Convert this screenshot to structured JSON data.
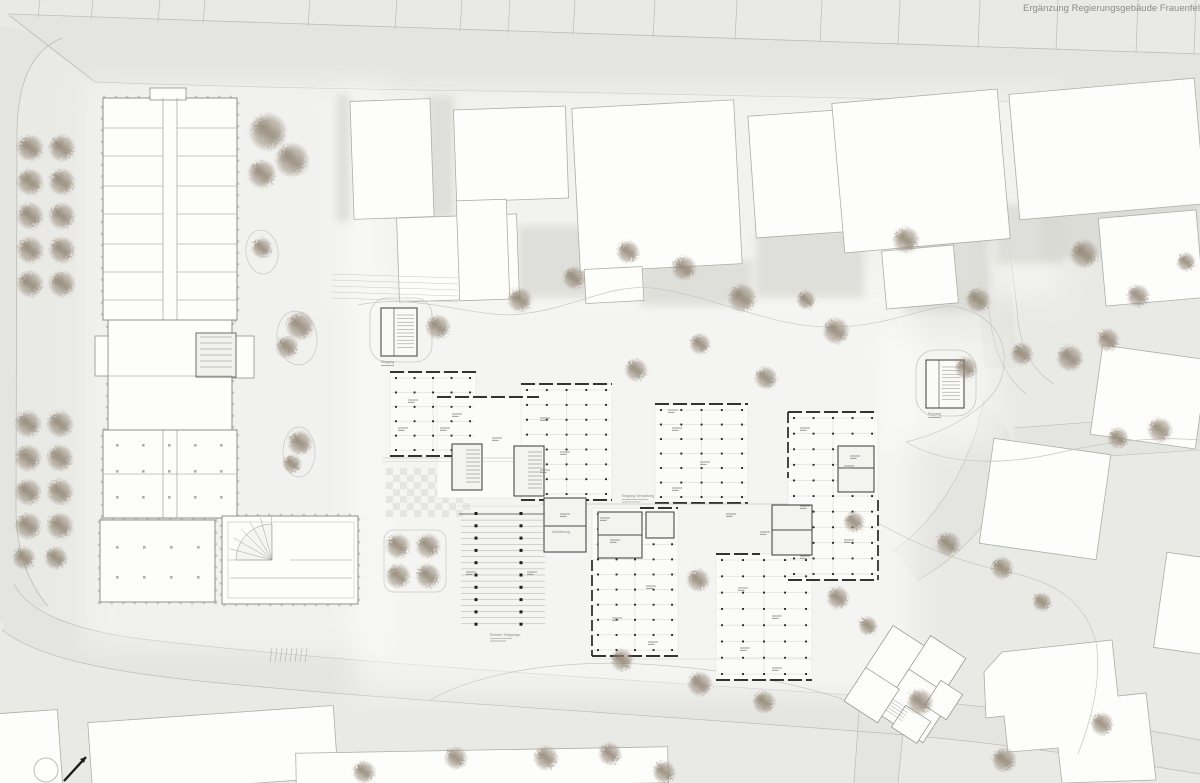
{
  "meta": {
    "title": "Ergänzung Regierungsgebäude Frauenfeld"
  },
  "annotations": {
    "entrance_west_label": "Eingang",
    "entrance_east_label": "Eingang",
    "delivery_label": "Anlieferung",
    "admin_entrance_label": "Eingang Verwaltung",
    "garage_label": "Einfahrt Tiefgarage"
  },
  "palette": {
    "background": "#e9e9e6",
    "road_fill": "#e4e4e1",
    "road_line": "#bdbdb8",
    "building_fill": "#fdfdfc",
    "building_stroke": "#aeaea8",
    "existing_stroke": "#8f8f89",
    "shadow": "#d5d5d0",
    "wall_dark": "#333330",
    "plan_line": "#c3c3bf",
    "thin_line": "#c7c7c3",
    "label_gray": "#8a8a85",
    "tree_main": "#988c7b",
    "tree_dark": "#7d7160",
    "title_color": "#8c8c8c",
    "north_arrow_black": "#1c1c1a"
  }
}
